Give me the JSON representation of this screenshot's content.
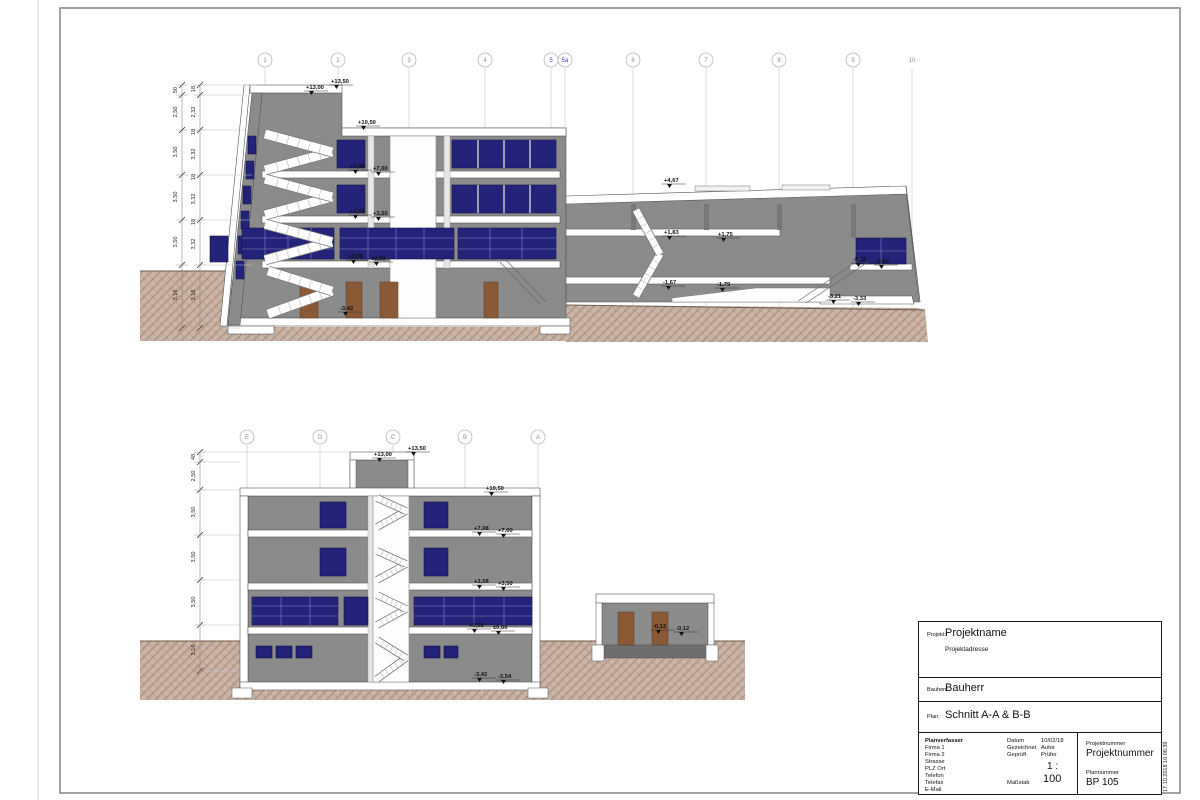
{
  "title_block": {
    "projekt_label": "Projekt:",
    "projekt": "Projektname",
    "projektadresse": "Projektadresse",
    "bauherr_label": "Bauherr:",
    "bauherr": "Bauherr",
    "plan_label": "Plan:",
    "plan": "Schnitt A-A & B-B",
    "planverfasser_label": "Planverfasser",
    "planverfasser_lines": [
      "Firma 1",
      "Firma 2",
      "Strasse",
      "PLZ Ort",
      "Telefon",
      "Telefax",
      "E-Mail"
    ],
    "datum_label": "Datum",
    "datum": "10/02/18",
    "gezeichnet_label": "Gezeichnet",
    "gezeichnet": "Autor",
    "geprueft_label": "Geprüft",
    "geprueft": "Prüfer",
    "massstab_label": "Maßstab",
    "massstab_top": "1 :",
    "massstab_value": "100",
    "projektnummer_label": "Projektnummer",
    "projektnummer": "Projektnummer",
    "plannummer_label": "Plannummer",
    "plannummer": "BP 105"
  },
  "stamp": "17.10.2018 16:06:39",
  "section_a": {
    "grids": [
      {
        "x": 265,
        "label": "1"
      },
      {
        "x": 338,
        "label": "2"
      },
      {
        "x": 409,
        "label": "3"
      },
      {
        "x": 485,
        "label": "4"
      },
      {
        "x": 551,
        "label": "5",
        "blue": true
      },
      {
        "x": 565,
        "label": "5a",
        "blue": true
      },
      {
        "x": 633,
        "label": "6"
      },
      {
        "x": 706,
        "label": "7"
      },
      {
        "x": 779,
        "label": "8"
      },
      {
        "x": 853,
        "label": "9"
      },
      {
        "x": 912,
        "label": "10",
        "nocircle": true
      }
    ],
    "dims_outer": [
      {
        "y": 90,
        "t": "50"
      },
      {
        "y": 112,
        "t": "2,50"
      },
      {
        "y": 152,
        "t": "3,50"
      },
      {
        "y": 197,
        "t": "3,50"
      },
      {
        "y": 242,
        "t": "3,50"
      },
      {
        "y": 295,
        "t": "3,16"
      }
    ],
    "dims_inner": [
      {
        "y": 89,
        "t": "18"
      },
      {
        "y": 112,
        "t": "2,32"
      },
      {
        "y": 132,
        "t": "18"
      },
      {
        "y": 154,
        "t": "3,32"
      },
      {
        "y": 177,
        "t": "18"
      },
      {
        "y": 199,
        "t": "3,32"
      },
      {
        "y": 222,
        "t": "18"
      },
      {
        "y": 244,
        "t": "3,32"
      },
      {
        "y": 295,
        "t": "3,16"
      }
    ],
    "levels": [
      {
        "x": 306,
        "y": 89,
        "t": "+13,00"
      },
      {
        "x": 331,
        "y": 83,
        "t": "+13,50"
      },
      {
        "x": 358,
        "y": 124,
        "t": "+10,50"
      },
      {
        "x": 350,
        "y": 168,
        "t": "+7,08"
      },
      {
        "x": 373,
        "y": 170,
        "t": "+7,00"
      },
      {
        "x": 350,
        "y": 213,
        "t": "+3,58"
      },
      {
        "x": 373,
        "y": 215,
        "t": "+3,50"
      },
      {
        "x": 348,
        "y": 258,
        "t": "+0,08"
      },
      {
        "x": 371,
        "y": 260,
        "t": "±0,00"
      },
      {
        "x": 340,
        "y": 310,
        "t": "-3,42"
      },
      {
        "x": 664,
        "y": 182,
        "t": "+4,67"
      },
      {
        "x": 664,
        "y": 234,
        "t": "+1,83"
      },
      {
        "x": 718,
        "y": 236,
        "t": "+1,75"
      },
      {
        "x": 663,
        "y": 284,
        "t": "-1,67"
      },
      {
        "x": 717,
        "y": 286,
        "t": "-1,79"
      },
      {
        "x": 853,
        "y": 261,
        "t": "-0,18"
      },
      {
        "x": 876,
        "y": 263,
        "t": "-0,62"
      },
      {
        "x": 828,
        "y": 298,
        "t": "-3,21"
      },
      {
        "x": 853,
        "y": 300,
        "t": "-3,33"
      }
    ]
  },
  "section_b": {
    "grids": [
      {
        "x": 247,
        "label": "E"
      },
      {
        "x": 320,
        "label": "D"
      },
      {
        "x": 393,
        "label": "C"
      },
      {
        "x": 465,
        "label": "B"
      },
      {
        "x": 538,
        "label": "A"
      }
    ],
    "dims": [
      {
        "y": 457,
        "t": "48"
      },
      {
        "y": 476,
        "t": "2,50"
      },
      {
        "y": 512,
        "t": "3,50"
      },
      {
        "y": 557,
        "t": "3,50"
      },
      {
        "y": 602,
        "t": "3,50"
      },
      {
        "y": 650,
        "t": "3,16"
      }
    ],
    "levels": [
      {
        "x": 374,
        "y": 456,
        "t": "+13,00"
      },
      {
        "x": 408,
        "y": 450,
        "t": "+13,50"
      },
      {
        "x": 486,
        "y": 490,
        "t": "+10,50"
      },
      {
        "x": 474,
        "y": 530,
        "t": "+7,08"
      },
      {
        "x": 498,
        "y": 532,
        "t": "+7,00"
      },
      {
        "x": 474,
        "y": 583,
        "t": "+3,58"
      },
      {
        "x": 498,
        "y": 585,
        "t": "+3,50"
      },
      {
        "x": 469,
        "y": 627,
        "t": "+0,08"
      },
      {
        "x": 493,
        "y": 629,
        "t": "±0,00"
      },
      {
        "x": 474,
        "y": 676,
        "t": "-3,42"
      },
      {
        "x": 498,
        "y": 678,
        "t": "-3,54"
      },
      {
        "x": 653,
        "y": 628,
        "t": "-0,12"
      },
      {
        "x": 676,
        "y": 630,
        "t": "-0,12"
      }
    ]
  },
  "colors": {
    "wall_gray": "#8b8b8b",
    "window_navy": "#23237a",
    "door_brown": "#8a5a36",
    "ground_base": "#c8b1a3",
    "grid_blue": "#3b3bc0"
  }
}
